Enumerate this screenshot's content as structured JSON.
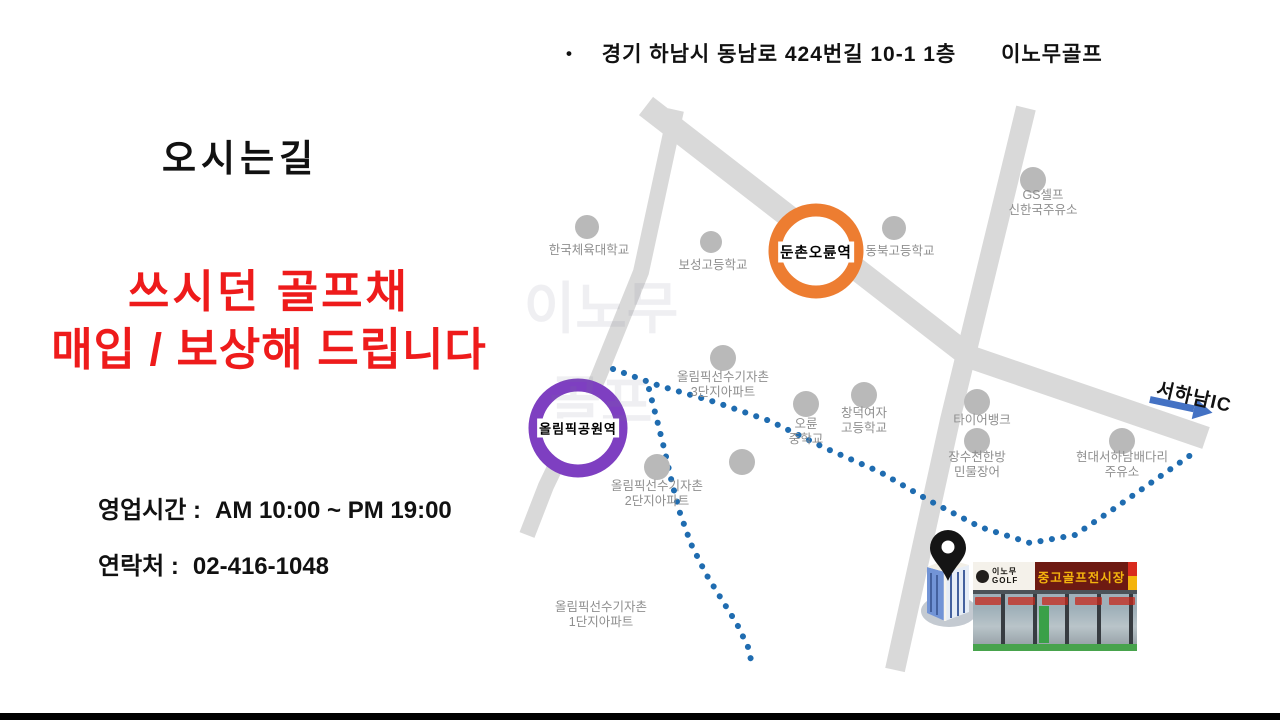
{
  "header": {
    "bullet": "•",
    "address": "경기 하남시 동남로 424번길 10-1 1층",
    "brand": "이노무골프"
  },
  "left": {
    "title": "오시는길",
    "promo_line1": "쓰시던 골프채",
    "promo_line2": "매입 / 보상해 드립니다",
    "hours_label": "영업시간 :",
    "hours_value": "AM 10:00 ~ PM 19:00",
    "phone_label": "연락처 :",
    "phone_value": "02-416-1048"
  },
  "map": {
    "watermark": "이노무\n골프",
    "stations": [
      {
        "name": "둔촌오륜역",
        "color": "#ed7d31"
      },
      {
        "name": "올림픽공원역",
        "color": "#7e3fc1"
      }
    ],
    "places": [
      {
        "label": "한국체육대학교"
      },
      {
        "label": "보성고등학교"
      },
      {
        "label": "동북고등학교"
      },
      {
        "label": "GS셀프\n신한국주유소"
      },
      {
        "label": "올림픽선수기자촌\n3단지아파트"
      },
      {
        "label": "오륜\n중학교"
      },
      {
        "label": "창덕여자\n고등학교"
      },
      {
        "label": "타이어뱅크"
      },
      {
        "label": "장수천한방\n민물장어"
      },
      {
        "label": "현대서하남배다리\n주유소"
      },
      {
        "label": "올림픽선수기자촌\n2단지아파트"
      },
      {
        "label": "올림픽선수기자촌\n1단지아파트"
      }
    ],
    "highway_label": "서하남IC",
    "route_color": "#1f6cb0",
    "road_color": "#d9d9d9",
    "arrow_color": "#4472c4"
  },
  "store": {
    "sign_brand": "이노무\nGOLF",
    "sign_main": "중고골프전시장"
  }
}
